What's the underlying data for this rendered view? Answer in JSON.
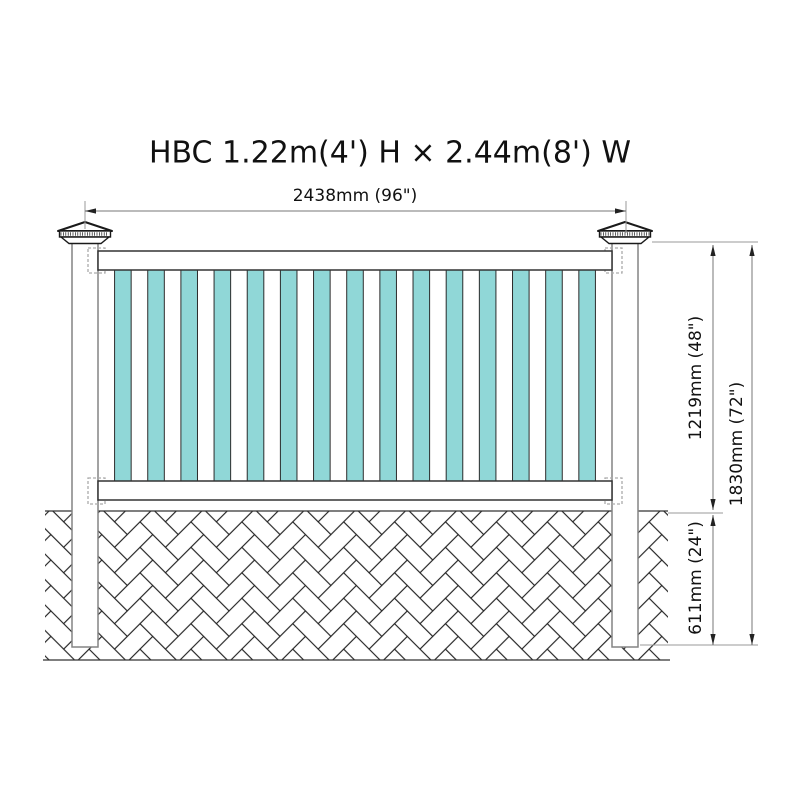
{
  "title": "HBC 1.22m(4') H × 2.44m(8') W",
  "dimensions": {
    "width": "2438mm (96\")",
    "panel_height": "1219mm (48\")",
    "overall_height": "1830mm (72\")",
    "buried_depth": "611mm (24\")"
  },
  "fence": {
    "picket_count": 15,
    "post_count": 2,
    "rail_count": 2,
    "ground_pattern": "herringbone-brick"
  },
  "colors": {
    "background": "#ffffff",
    "picket_fill": "#90D7D7",
    "picket_outline": "#2b2b2b",
    "rail_outline": "#333333",
    "post_outline": "#848484",
    "cap_outline": "#1a1a1a",
    "bracket_outline": "#aaaaaa",
    "ground_line": "#333333",
    "brick_line": "#222222",
    "dim_line": "#777777",
    "ext_line": "#999999",
    "arrow": "#222222",
    "text": "#111111"
  }
}
